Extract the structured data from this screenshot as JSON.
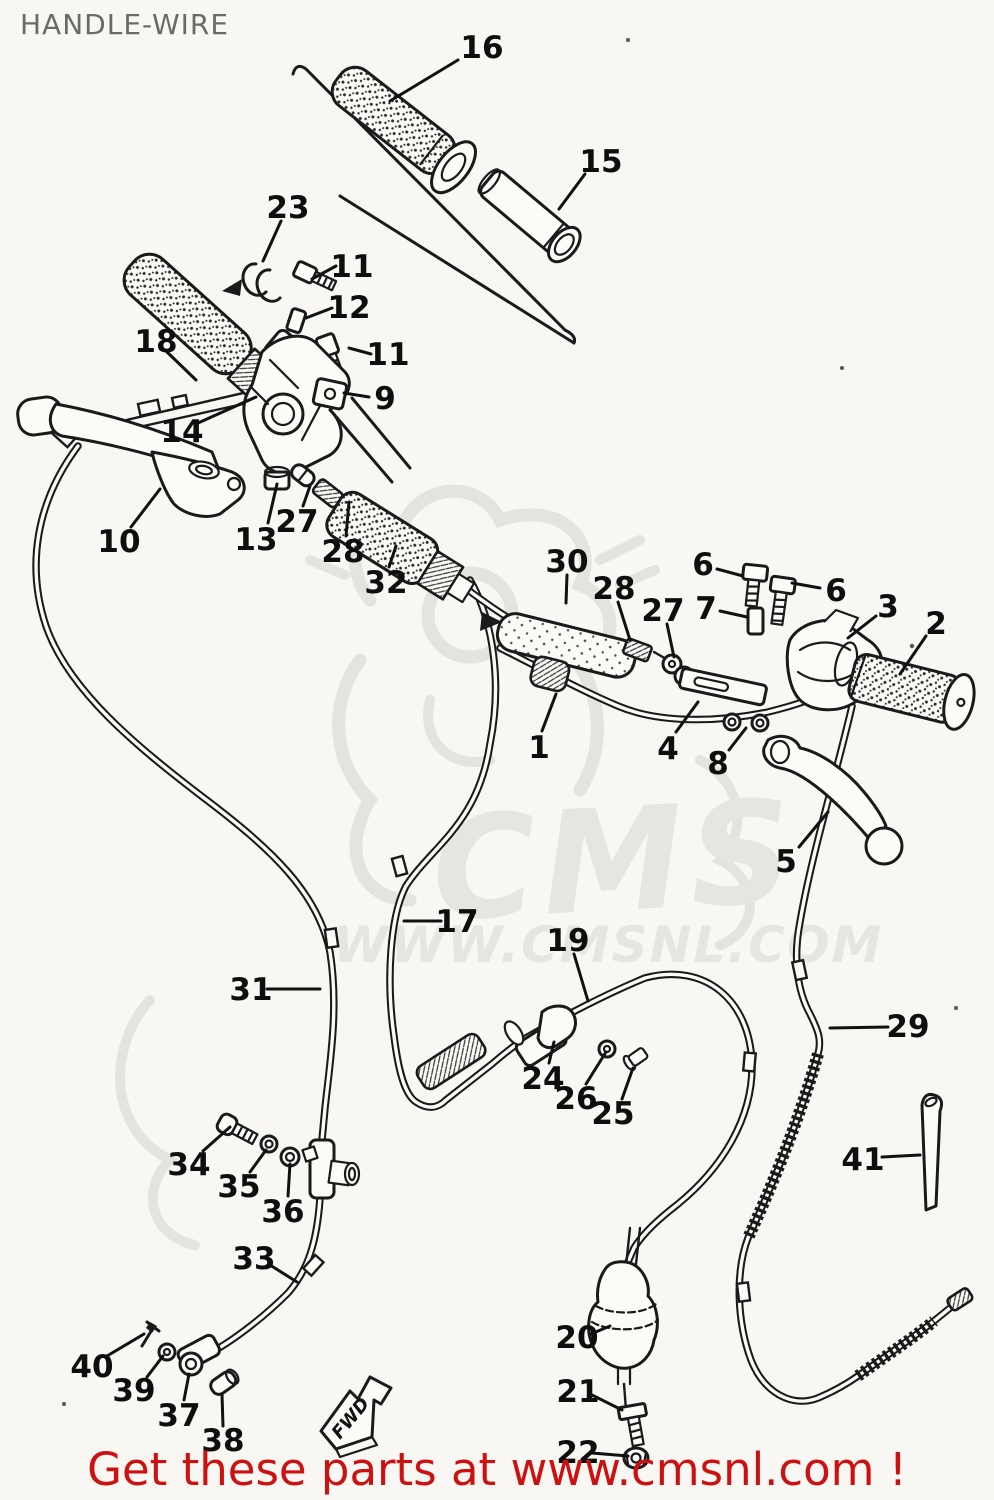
{
  "page": {
    "title": "HANDLE-WIRE",
    "footer_text": "Get these parts at www.cmsnl.com !",
    "footer_color": "#cc1111",
    "title_color": "#6b6b66",
    "background": "#f8f7f4",
    "line_color": "#1a1a1a"
  },
  "watermark": {
    "brand": "CMS",
    "url_text": "WWW.CMSNL.COM",
    "color": "#e6e5e0"
  },
  "diagram": {
    "fwd_marker": "FWD",
    "labels": [
      {
        "n": "16",
        "x": 482,
        "y": 47,
        "l": [
          458,
          60,
          390,
          101
        ]
      },
      {
        "n": "15",
        "x": 601,
        "y": 161,
        "l": [
          585,
          174,
          559,
          209
        ]
      },
      {
        "n": "23",
        "x": 288,
        "y": 207,
        "l": [
          281,
          221,
          263,
          261
        ]
      },
      {
        "n": "11",
        "x": 352,
        "y": 266,
        "l": [
          336,
          266,
          312,
          279
        ]
      },
      {
        "n": "12",
        "x": 349,
        "y": 307,
        "l": [
          332,
          308,
          306,
          318
        ]
      },
      {
        "n": "11",
        "x": 388,
        "y": 354,
        "l": [
          371,
          354,
          349,
          348
        ]
      },
      {
        "n": "18",
        "x": 156,
        "y": 341,
        "l": [
          167,
          352,
          196,
          380
        ]
      },
      {
        "n": "9",
        "x": 385,
        "y": 398,
        "l": [
          369,
          397,
          344,
          393
        ]
      },
      {
        "n": "14",
        "x": 182,
        "y": 431,
        "l": [
          198,
          423,
          256,
          397
        ]
      },
      {
        "n": "10",
        "x": 119,
        "y": 541,
        "l": [
          131,
          527,
          160,
          489
        ]
      },
      {
        "n": "13",
        "x": 256,
        "y": 539,
        "l": [
          268,
          523,
          277,
          484
        ]
      },
      {
        "n": "27",
        "x": 297,
        "y": 521,
        "l": [
          303,
          506,
          310,
          486
        ]
      },
      {
        "n": "28",
        "x": 343,
        "y": 551,
        "l": [
          346,
          536,
          349,
          502
        ]
      },
      {
        "n": "32",
        "x": 386,
        "y": 582,
        "l": [
          389,
          567,
          396,
          546
        ]
      },
      {
        "n": "30",
        "x": 567,
        "y": 561,
        "l": [
          567,
          575,
          566,
          603
        ]
      },
      {
        "n": "28",
        "x": 614,
        "y": 588,
        "l": [
          618,
          602,
          630,
          640
        ]
      },
      {
        "n": "27",
        "x": 663,
        "y": 610,
        "l": [
          667,
          624,
          674,
          657
        ]
      },
      {
        "n": "6",
        "x": 703,
        "y": 564,
        "l": [
          717,
          569,
          743,
          576
        ]
      },
      {
        "n": "6",
        "x": 836,
        "y": 590,
        "l": [
          820,
          588,
          792,
          583
        ]
      },
      {
        "n": "7",
        "x": 706,
        "y": 608,
        "l": [
          720,
          611,
          747,
          617
        ]
      },
      {
        "n": "3",
        "x": 888,
        "y": 606,
        "l": [
          876,
          616,
          848,
          638
        ]
      },
      {
        "n": "2",
        "x": 936,
        "y": 623,
        "l": [
          926,
          636,
          900,
          674
        ]
      },
      {
        "n": "1",
        "x": 539,
        "y": 747,
        "l": [
          542,
          731,
          556,
          694
        ]
      },
      {
        "n": "4",
        "x": 668,
        "y": 748,
        "l": [
          676,
          732,
          698,
          702
        ]
      },
      {
        "n": "8",
        "x": 718,
        "y": 763,
        "l": [
          729,
          750,
          746,
          728
        ]
      },
      {
        "n": "5",
        "x": 786,
        "y": 861,
        "l": [
          799,
          847,
          828,
          812
        ]
      },
      {
        "n": "17",
        "x": 457,
        "y": 921,
        "l": [
          441,
          921,
          404,
          921
        ]
      },
      {
        "n": "19",
        "x": 568,
        "y": 940,
        "l": [
          574,
          954,
          588,
          1001
        ]
      },
      {
        "n": "31",
        "x": 251,
        "y": 989,
        "l": [
          267,
          989,
          320,
          989
        ]
      },
      {
        "n": "29",
        "x": 908,
        "y": 1026,
        "l": [
          888,
          1027,
          830,
          1028
        ]
      },
      {
        "n": "24",
        "x": 543,
        "y": 1078,
        "l": [
          549,
          1063,
          554,
          1042
        ]
      },
      {
        "n": "26",
        "x": 576,
        "y": 1098,
        "l": [
          586,
          1084,
          606,
          1052
        ]
      },
      {
        "n": "25",
        "x": 613,
        "y": 1113,
        "l": [
          622,
          1099,
          633,
          1068
        ]
      },
      {
        "n": "41",
        "x": 863,
        "y": 1159,
        "l": [
          882,
          1157,
          920,
          1155
        ]
      },
      {
        "n": "34",
        "x": 189,
        "y": 1164,
        "l": [
          203,
          1151,
          230,
          1127
        ]
      },
      {
        "n": "35",
        "x": 239,
        "y": 1186,
        "l": [
          250,
          1172,
          266,
          1150
        ]
      },
      {
        "n": "36",
        "x": 283,
        "y": 1211,
        "l": [
          288,
          1196,
          290,
          1164
        ]
      },
      {
        "n": "33",
        "x": 254,
        "y": 1258,
        "l": [
          270,
          1265,
          297,
          1282
        ]
      },
      {
        "n": "40",
        "x": 92,
        "y": 1366,
        "l": [
          107,
          1356,
          144,
          1334
        ]
      },
      {
        "n": "39",
        "x": 134,
        "y": 1390,
        "l": [
          147,
          1377,
          163,
          1356
        ]
      },
      {
        "n": "37",
        "x": 179,
        "y": 1415,
        "l": [
          184,
          1400,
          189,
          1374
        ]
      },
      {
        "n": "38",
        "x": 223,
        "y": 1440,
        "l": [
          223,
          1426,
          222,
          1394
        ]
      },
      {
        "n": "20",
        "x": 577,
        "y": 1337,
        "l": [
          591,
          1334,
          610,
          1326
        ]
      },
      {
        "n": "21",
        "x": 578,
        "y": 1391,
        "l": [
          592,
          1395,
          622,
          1410
        ]
      },
      {
        "n": "22",
        "x": 578,
        "y": 1452,
        "l": [
          592,
          1453,
          628,
          1456
        ]
      }
    ]
  }
}
